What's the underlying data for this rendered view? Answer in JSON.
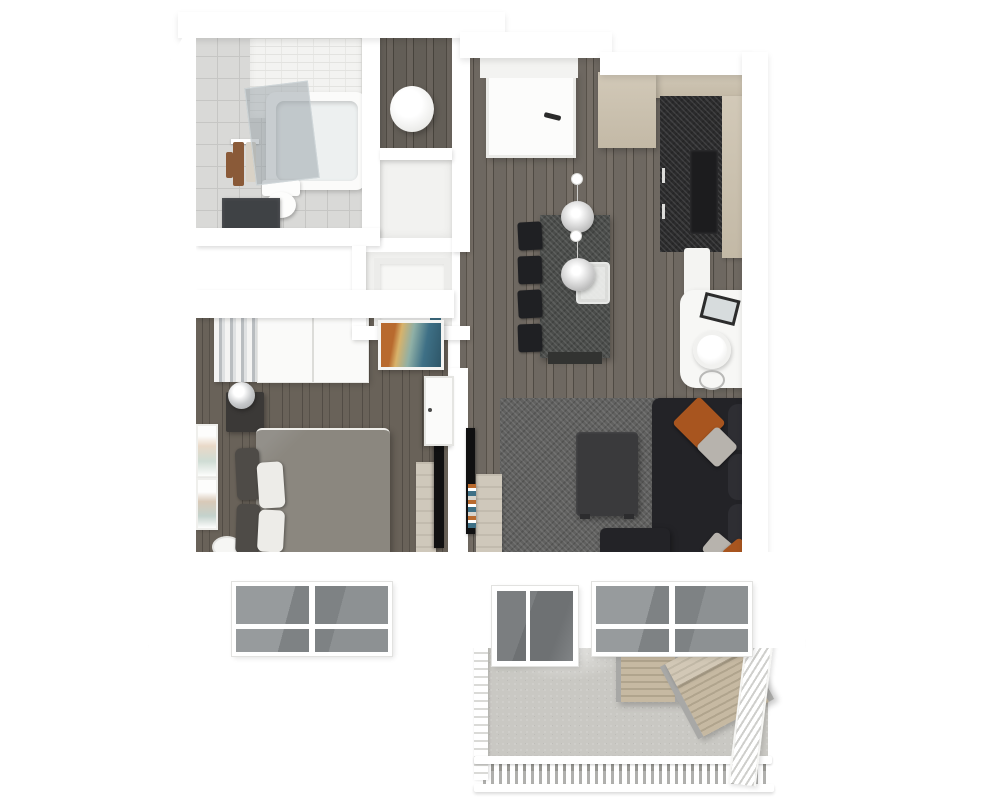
{
  "scene": {
    "description": "3D rendered top-down floor plan of a one-bedroom apartment with balcony",
    "background": "#ffffff"
  },
  "palette": {
    "wall": "#ffffff",
    "wood1": "#6e6861",
    "wood2": "#575149",
    "wood3": "#766f67",
    "wood4": "#4f4a43",
    "bedwood1": "#696259",
    "bedwood2": "#524c45",
    "tile": "#d9d9d7",
    "tileLine": "#c6c6c4",
    "tileWall": "#f3f3f1",
    "tub": "#fbfbfa",
    "glass": "rgba(150,160,166,0.5)",
    "cabinet": "#d2c9b8",
    "cabinetDark": "#c3b9a6",
    "counter": "#2b2b2c",
    "appliance": "#1c1c1e",
    "rug": "#616160",
    "sofa": "#232327",
    "sofaCushion": "#2e2e33",
    "pillowRust": "#a8551f",
    "pillowGray": "#b7b3ad",
    "pillowWhite": "#edece8",
    "coffeeTable": "#3a3a3c",
    "diningTable": "#4b4d4b",
    "chair": "#1f2023",
    "bed": "#8b877f",
    "bedCushion": "#4e4b47",
    "nightstand": "#3b3937",
    "lampSilver": "#c7c9cb",
    "consoleWood": "#cfc8bb",
    "tv": "#101011",
    "deck": "#c9c8c3",
    "deckFurn1": "#c6b9a2",
    "deckFurn2": "#b0a48d",
    "furnFrame": "#a8a8a6",
    "glassDark": "#6e7173",
    "glassWin": "#868a8c",
    "towelBrown": "#8a5a38",
    "towelCream": "#d9d2c6",
    "artOrange": "#b86a2e",
    "artTeal": "#3e7086"
  },
  "rooms": {
    "bathroom": {
      "name": "Bathroom",
      "items": [
        "bathtub",
        "glass shower screen",
        "toilet",
        "vanity counter",
        "towel rack",
        "tiled wall"
      ]
    },
    "utility": {
      "name": "Utility closet",
      "items": [
        "water heater"
      ]
    },
    "closets": {
      "name": "Hall closets",
      "items": [
        "shelving",
        "linens"
      ]
    },
    "entry": {
      "name": "Entry",
      "items": [
        "front door"
      ]
    },
    "kitchen": {
      "name": "Kitchen",
      "items": [
        "pantry cabinet",
        "upper cabinets",
        "dark countertop",
        "cooktop",
        "white appliance"
      ]
    },
    "dining": {
      "name": "Dining area",
      "items": [
        "dining table",
        "four chairs",
        "two pendant lamps",
        "serving tray"
      ]
    },
    "living": {
      "name": "Living area",
      "items": [
        "sectional sofa",
        "accent pillows",
        "coffee table",
        "area rug",
        "wall tv",
        "media console",
        "console desk",
        "table lamp"
      ]
    },
    "bedroom": {
      "name": "Bedroom",
      "items": [
        "double bed",
        "headboard cushions",
        "pillows",
        "nightstand",
        "sphere lamp",
        "wardrobe",
        "curtains",
        "wall art",
        "wall tv",
        "media console",
        "open door",
        "laundry basket",
        "framed prints"
      ]
    },
    "balcony": {
      "name": "Balcony",
      "items": [
        "white railing",
        "slatted side table",
        "slatted lounge chair"
      ]
    },
    "facade": {
      "name": "Exterior wall",
      "items": [
        "bedroom window",
        "sliding glass door",
        "living room window"
      ]
    }
  }
}
